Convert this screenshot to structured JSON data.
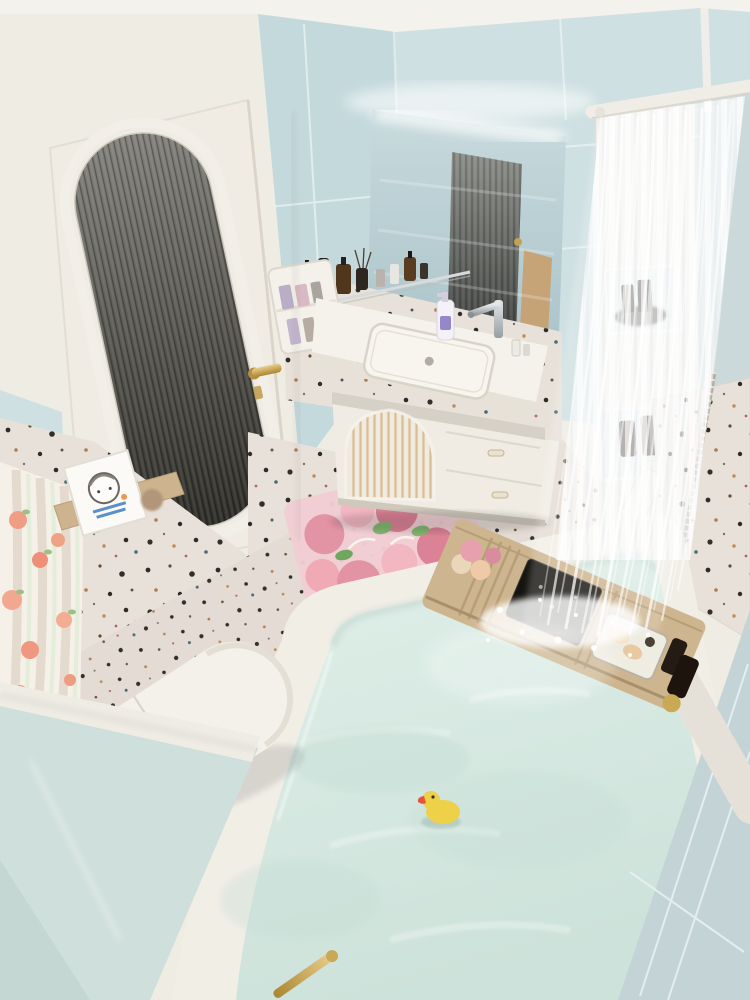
{
  "scene": {
    "kind": "photorealistic-3d-render",
    "view": "high-angle corner view looking down",
    "room": "small pastel bathroom with terrazzo accents, filled bathtub and waterfall shower"
  },
  "palette": {
    "ceiling": "#f4f2ec",
    "wallWhite": "#efece4",
    "wallBlueA": "#c4d9dc",
    "wallBlueB": "#cfe0e2",
    "wallBlueSliver": "#ccd9da",
    "nearWallGreen": "#cfdfdb",
    "nearWallBlue": "#c4d3d5",
    "terrazzoBase": "#e7e1d9",
    "floorBase": "#e4dcd4",
    "glassDark": "#35342f",
    "mirror": "#bed3d7",
    "water": "#d8e9e2",
    "tubWhite": "#f1eee6",
    "brass": "#c6a254",
    "duckYellow": "#eed049",
    "duckBeak": "#e2543c",
    "woodCaddy": "#cdb58f",
    "rugBase": "#f0cdd4",
    "rugPink": "#e293a4",
    "rugGreen": "#85b671",
    "chrome": "#b9bec0",
    "amberBottle": "#46311b",
    "peach": "#f09b83",
    "organizerWhite": "#f4f1ea"
  },
  "objects": [
    {
      "name": "ceiling",
      "label": "white ceiling strip"
    },
    {
      "name": "blue-tile-walls",
      "label": "light blue tiled back walls"
    },
    {
      "name": "fluted-glass-door",
      "label": "white door with arched dark fluted glass panel"
    },
    {
      "name": "brass-door-handle",
      "label": "brass lever handle"
    },
    {
      "name": "backlit-mirror",
      "label": "LED backlit vanity mirror reflecting the door"
    },
    {
      "name": "toiletry-shelf",
      "label": "shelf with amber and black toiletry bottles"
    },
    {
      "name": "wall-organizer",
      "label": "white wall organizer with lavender bottles"
    },
    {
      "name": "vanity-counter",
      "label": "white vanity counter with undermount sink"
    },
    {
      "name": "chrome-faucet",
      "label": "chrome basin faucet"
    },
    {
      "name": "soap-dispenser",
      "label": "white pump bottle with purple label"
    },
    {
      "name": "fluted-arch-cabinet",
      "label": "vanity cabinet with fluted arch door and drawers"
    },
    {
      "name": "terrazzo-accent-wall",
      "label": "speckled terrazzo half wall"
    },
    {
      "name": "art-print",
      "label": "small framed cartoon-girl print on wooden ledge"
    },
    {
      "name": "peach-shower-curtain",
      "label": "peach patterned curtain at left edge"
    },
    {
      "name": "toilet",
      "label": "white one-piece toilet seen from above"
    },
    {
      "name": "gold-sprayer",
      "label": "brass bidet sprayer beside toilet"
    },
    {
      "name": "tulip-bath-mat",
      "label": "pink tulip floor mat with script motif"
    },
    {
      "name": "terrazzo-floor",
      "label": "speckled terrazzo floor"
    },
    {
      "name": "bathtub",
      "label": "built-in white bathtub full of water"
    },
    {
      "name": "rubber-duck",
      "label": "yellow rubber duck with red beak"
    },
    {
      "name": "wooden-bath-caddy",
      "label": "wooden bath caddy tray across the tub"
    },
    {
      "name": "bath-bombs",
      "label": "pink and cream bath bombs"
    },
    {
      "name": "tablet",
      "label": "dark tablet propped on the caddy"
    },
    {
      "name": "soap-tray",
      "label": "metal tray with soap bars"
    },
    {
      "name": "amber-bath-bottles",
      "label": "dark amber bottles at tub corner"
    },
    {
      "name": "waterfall-shower",
      "label": "waterfall of shower water pouring into tub"
    },
    {
      "name": "sheer-shower-curtain",
      "label": "white sheer pleated shower curtain on rod"
    },
    {
      "name": "shower-niches",
      "label": "white shower shelving niches with dark bottles"
    },
    {
      "name": "hand-shower",
      "label": "white handheld shower head"
    },
    {
      "name": "towel-on-rim",
      "label": "ribbed white towel over the tub rim"
    },
    {
      "name": "near-walls",
      "label": "pale green and blue near walls in foreground"
    }
  ]
}
